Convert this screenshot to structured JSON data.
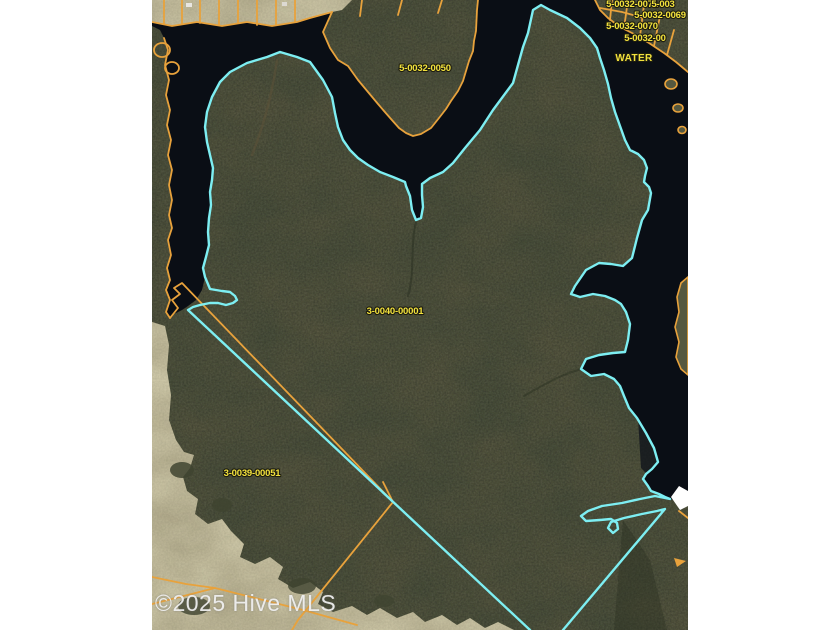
{
  "map": {
    "watermark": "©2025 Hive MLS",
    "labels": {
      "subject_parcel": "3-0040-00001",
      "neighbor_sw": "3-0039-00051",
      "peninsula": "5-0032-0050",
      "ne_row1a": "5-0032-0071",
      "ne_row1b": "5-003",
      "ne_row2": "5-0032-0069",
      "ne_row3": "5-0032-0070",
      "ne_row4": "5-0032-00",
      "water": "WATER"
    },
    "colors": {
      "background": "#ffffff",
      "water": "#0a0e15",
      "forest": "#4a4f3d",
      "field": "#ccc6a6",
      "parcel_line": "#e8a23c",
      "subject_outline": "#7deef2",
      "label_text": "#f2e13d",
      "watermark_text": "#f2f2f2"
    }
  }
}
